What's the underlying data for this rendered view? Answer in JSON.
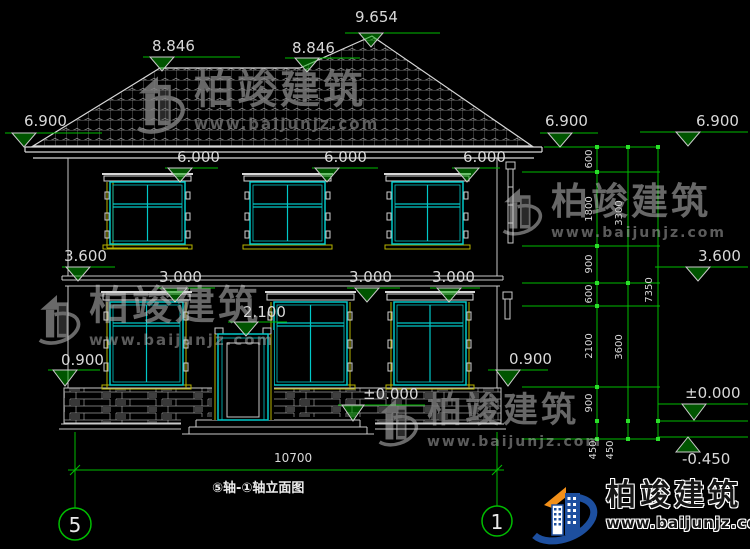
{
  "title_bar": {
    "drawing_title": "⑤轴-①轴立面图",
    "axis_bubbles": {
      "left": "5",
      "right": "1"
    }
  },
  "elevations": {
    "roof_peak": "9.654",
    "ridge_left": "8.846",
    "ridge_right": "8.846",
    "eave_left": "6.900",
    "eave_right": "6.900",
    "eave_far_right": "6.900",
    "floor2_window_tops": [
      "6.000",
      "6.000",
      "6.000"
    ],
    "floor2_level_left": "3.600",
    "floor2_level_right": "3.600",
    "floor1_window_tops": [
      "3.000",
      "3.000",
      "3.000"
    ],
    "door_top": "2.100",
    "window_sill_left": "0.900",
    "window_sill_right": "0.900",
    "ground_center": "±0.000",
    "ground_right": "±0.000",
    "foundation_right": "-0.450"
  },
  "dimensions": {
    "total_width": "10700",
    "chain_inner": [
      "600",
      "1800",
      "900",
      "600",
      "2100",
      "900",
      "450",
      "450"
    ],
    "chain_middle": [
      "3300",
      "3600"
    ],
    "chain_outer": "7350"
  },
  "watermark": {
    "brand": "柏竣建筑",
    "url": "www.baijunjz.com"
  },
  "logo": {
    "brand": "柏竣建筑",
    "url": "www.baijunjz.com"
  },
  "colors": {
    "dimension_green": "#00bd00",
    "window_cyan": "#00c8c8",
    "trim_yellow": "#b8b400",
    "line_white": "#d8d8d8",
    "logo_blue": "#1d4f9f",
    "logo_orange": "#f39019"
  }
}
